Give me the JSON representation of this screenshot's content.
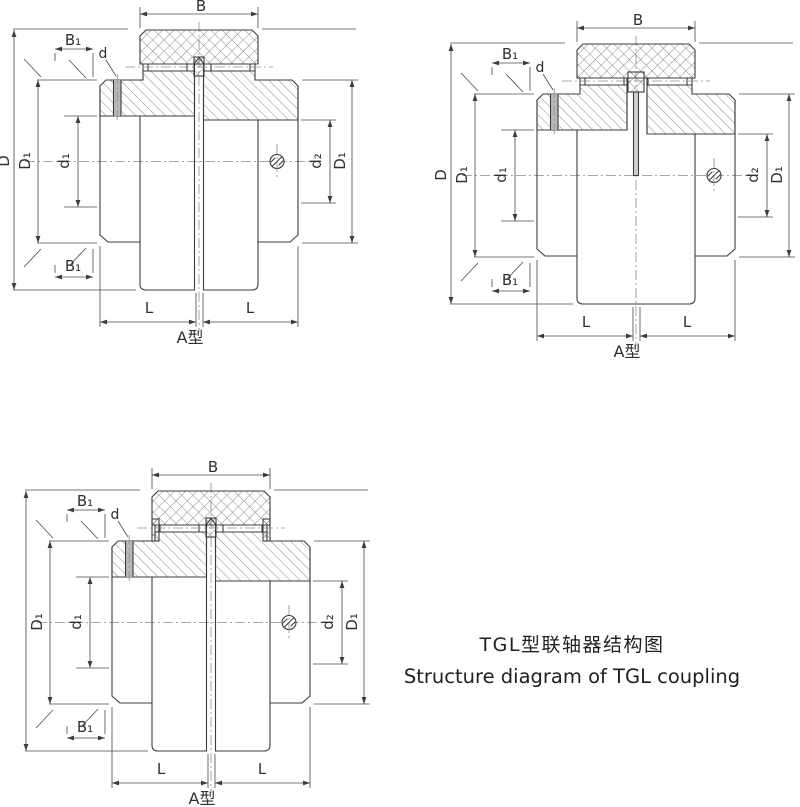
{
  "page": {
    "background": "#ffffff",
    "description_labels_present": [
      "B",
      "B₁",
      "d",
      "D",
      "D₁",
      "d₁",
      "d₂",
      "L",
      "A型"
    ]
  },
  "colors": {
    "outline": "#3c3c3c",
    "dimension_line": "#4a4a4a",
    "hatch": "#6e6e6e",
    "centerline": "#8c8c8c",
    "hole_fill": "#b8b8b8",
    "spacer_fill": "#cfcfcf",
    "text": "#2f2f2f",
    "background": "#ffffff"
  },
  "caption": {
    "title_zh": "TGL型联轴器结构图",
    "title_en": "Structure diagram of TGL coupling"
  },
  "figures": [
    {
      "name": "coupling-section-top-left",
      "variant": "plain",
      "type_label": "A型",
      "labels": {
        "B": "B",
        "B1": "B₁",
        "d": "d",
        "D": "D",
        "D1": "D₁",
        "d1": "d₁",
        "d2": "d₂",
        "L": "L"
      }
    },
    {
      "name": "coupling-section-top-right-with-spacer",
      "variant": "spacer",
      "type_label": "A型",
      "labels": {
        "B": "B",
        "B1": "B₁",
        "d": "d",
        "D": "D",
        "D1": "D₁",
        "d1": "d₁",
        "d2": "d₂",
        "L": "L"
      }
    },
    {
      "name": "coupling-section-bottom-left-with-end-plates",
      "variant": "tabs",
      "type_label": "A型",
      "labels": {
        "B": "B",
        "B1": "B₁",
        "d": "d",
        "D1": "D₁",
        "d1": "d₁",
        "d2": "d₂",
        "L": "L"
      }
    }
  ]
}
